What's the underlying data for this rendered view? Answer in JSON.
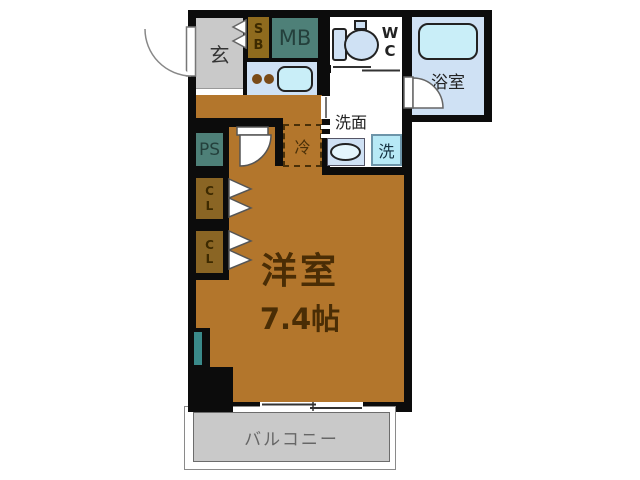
{
  "plan": {
    "unit": {
      "genkan_label": "玄",
      "shoe_box": {
        "l1": "S",
        "l2": "B"
      },
      "meter_box": "MB",
      "wc": {
        "l1": "W",
        "l2": "C"
      },
      "bathroom": "浴室",
      "washroom": "洗面",
      "washer": "洗",
      "fridge": "冷",
      "pipe_space": "PS",
      "closet1": {
        "l1": "C",
        "l2": "L"
      },
      "closet2": {
        "l1": "C",
        "l2": "L"
      },
      "room_name": "洋室",
      "room_size": "7.4帖",
      "balcony": "バルコニー"
    },
    "colors": {
      "wall": "#0c0c0c",
      "floor": "#b3762c",
      "closet": "#8a6524",
      "teal": "#4e8078",
      "light_blue": "#cfe1f4",
      "cyan": "#c9eef8",
      "washer_blue": "#b7e9f6",
      "window_teal": "#3a8a8a",
      "gray": "#c9c9c9",
      "room_text": "#4a2d05"
    }
  }
}
